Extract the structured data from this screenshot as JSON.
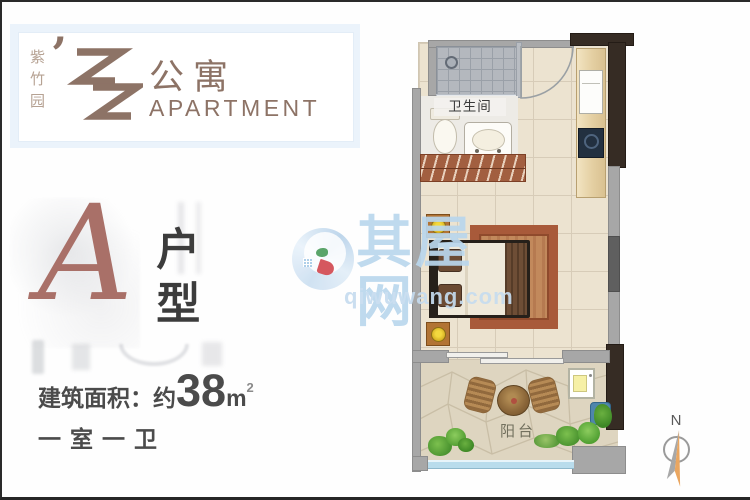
{
  "brand": {
    "vertical_name": "紫竹园",
    "apostrophe": "’",
    "cn_name": "公寓",
    "en_name": "APARTMENT"
  },
  "unit": {
    "letter": "A",
    "type_label": "户型"
  },
  "specs": {
    "area_label": "建筑面积：约",
    "area_value": "38",
    "area_unit": "m",
    "area_exponent": "2",
    "layout_label": "一室一卫"
  },
  "floorplan": {
    "bathroom_label": "卫生间",
    "balcony_label": "阳台"
  },
  "compass": {
    "north_label": "N"
  },
  "watermark": {
    "site_name": "其屋网",
    "site_url": "qiwuwang.com"
  },
  "colors": {
    "brand_taupe": "#8d7366",
    "unit_accent": "#a97068",
    "text_dark": "#4b4b4b",
    "watermark_blue": "#bad7ed",
    "wall_gray": "#a7a7a7",
    "wall_dark": "#362c24"
  }
}
